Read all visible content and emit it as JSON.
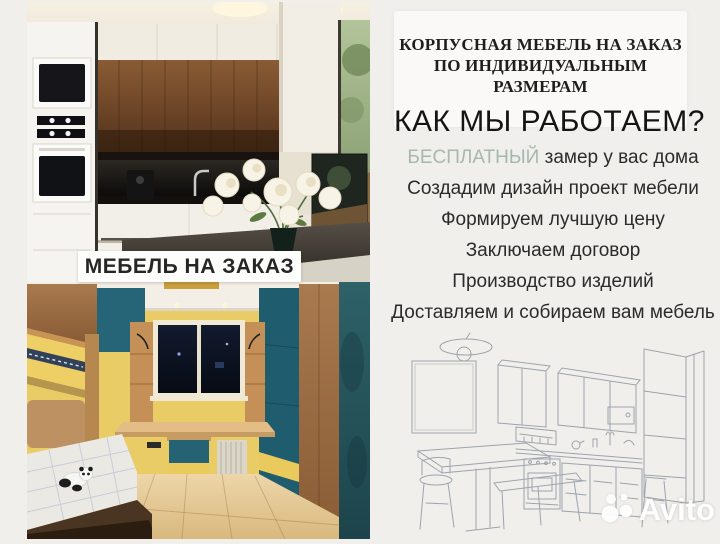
{
  "colors": {
    "background": "#f1efec",
    "card": "#fbf9f7",
    "highlight": "#a6b7ae",
    "text_dark": "#2b2b2b",
    "banner_bg": "#fdfdfc"
  },
  "left": {
    "banner_label": "МЕБЕЛЬ НА ЗАКАЗ"
  },
  "right": {
    "header_line1": "КОРПУСНАЯ МЕБЕЛЬ НА ЗАКАЗ",
    "header_line2": "ПО ИНДИВИДУАЛЬНЫМ РАЗМЕРАМ",
    "heading": "КАК МЫ РАБОТАЕМ?",
    "steps": [
      {
        "highlight": "БЕСПЛАТНЫЙ",
        "text": "замер у вас дома"
      },
      {
        "text": "Создадим дизайн проект мебели"
      },
      {
        "text": "Формируем лучшую цену"
      },
      {
        "text": "Заключаем договор"
      },
      {
        "text": "Производство изделий"
      },
      {
        "text": "Доставляем и собираем вам мебель"
      }
    ]
  },
  "watermark": {
    "brand": "Avito"
  }
}
